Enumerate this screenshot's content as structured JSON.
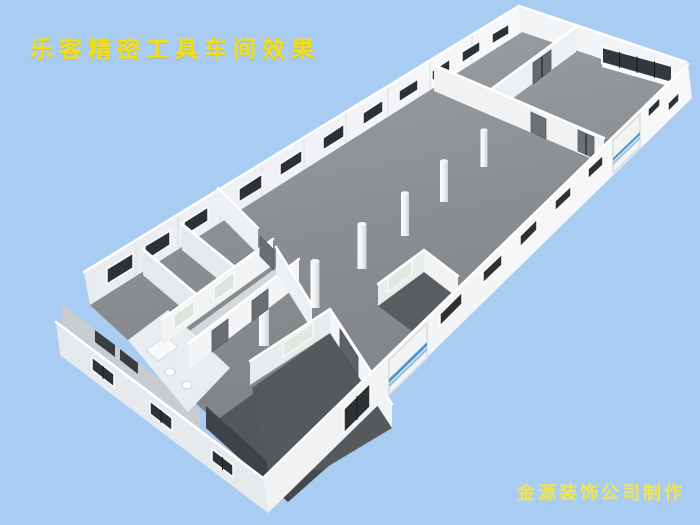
{
  "title": {
    "text": "乐客精密工具车间效果",
    "color": "#F3DE14"
  },
  "credit": {
    "text": "金源装饰公司制作",
    "color": "#EFE553"
  },
  "scene": {
    "description": "3D aerial cutaway rendering of a precision tool workshop (no roof), long rectangular hall viewed at an angle",
    "background_color": "#A9CCF2",
    "hall_floor_color": "#8A8D90",
    "wall_color": "#F2F4F6",
    "room_floor_color": "#54575A",
    "window_color": "#2E3134",
    "frosted_window_color": "#DCE6DC",
    "door_color": "#6B6E71",
    "garage_door_stripe_color": "#4D96CE",
    "column_count": 6,
    "far_wall_window_count": 11,
    "near_wall_window_count": 8,
    "west_wall_window_count": 3,
    "end_wall_window_panels": 4,
    "garage_door_count": 2,
    "interior_door_count": 9
  }
}
